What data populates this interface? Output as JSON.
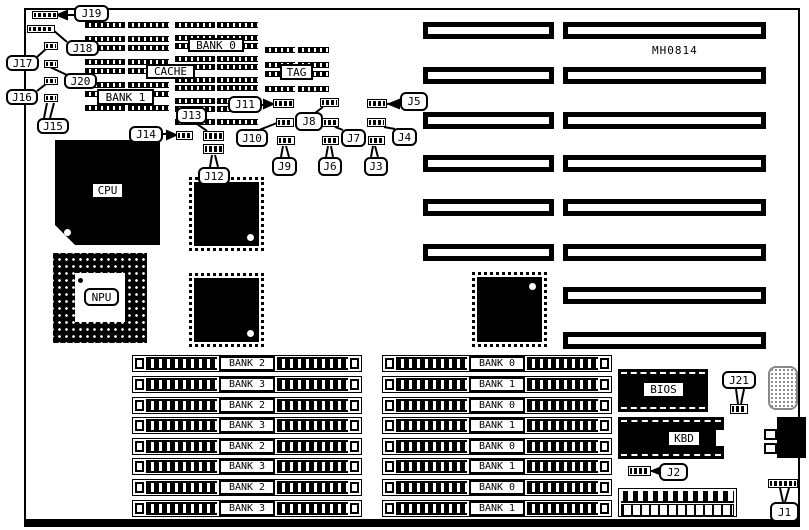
{
  "board": {
    "part_number": "MH0814"
  },
  "chips": {
    "cpu": "CPU",
    "npu": "NPU",
    "bios": "BIOS",
    "kbd": "KBD",
    "cache": "CACHE",
    "tag": "TAG",
    "bank0": "BANK 0",
    "bank1": "BANK 1"
  },
  "jumpers": {
    "j1": "J1",
    "j2": "J2",
    "j3": "J3",
    "j4": "J4",
    "j5": "J5",
    "j6": "J6",
    "j7": "J7",
    "j8": "J8",
    "j9": "J9",
    "j10": "J10",
    "j11": "J11",
    "j12": "J12",
    "j13": "J13",
    "j14": "J14",
    "j15": "J15",
    "j16": "J16",
    "j17": "J17",
    "j18": "J18",
    "j19": "J19",
    "j20": "J20",
    "j21": "J21"
  },
  "memory": {
    "left_rows": [
      "BANK 2",
      "BANK 3",
      "BANK 2",
      "BANK 3",
      "BANK 2",
      "BANK 3",
      "BANK 2",
      "BANK 3"
    ],
    "right_rows": [
      "BANK 0",
      "BANK 1",
      "BANK 0",
      "BANK 1",
      "BANK 0",
      "BANK 1",
      "BANK 0",
      "BANK 1"
    ]
  }
}
